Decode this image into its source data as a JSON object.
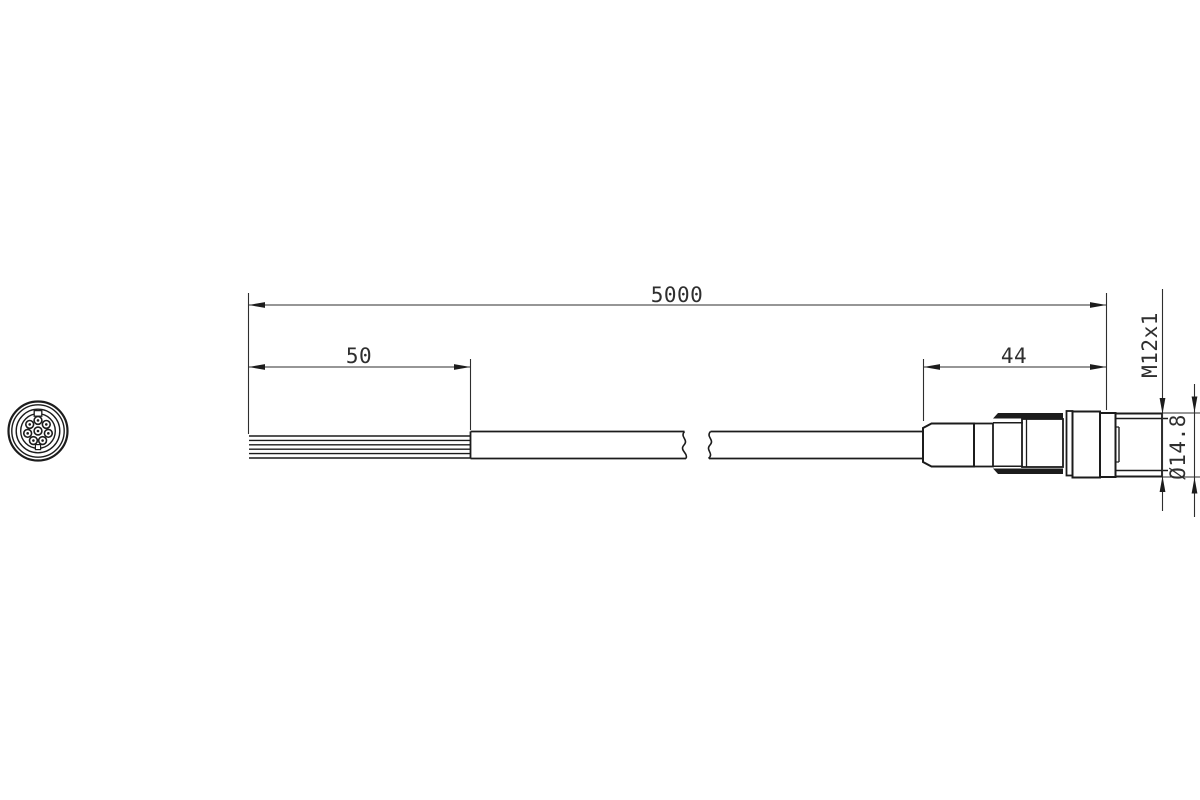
{
  "dimensions": {
    "overall_length": "5000",
    "strip_length": "50",
    "connector_length": "44",
    "thread": "M12x1",
    "diameter": "Ø14.8"
  },
  "connector_face": {
    "ring_pins": 7,
    "center_pin": 1,
    "total_pins": 8
  },
  "colors": {
    "line": "#1c1c1c",
    "dimension": "#2e2e2e",
    "text": "#2f2f2f",
    "background": "#ffffff"
  }
}
